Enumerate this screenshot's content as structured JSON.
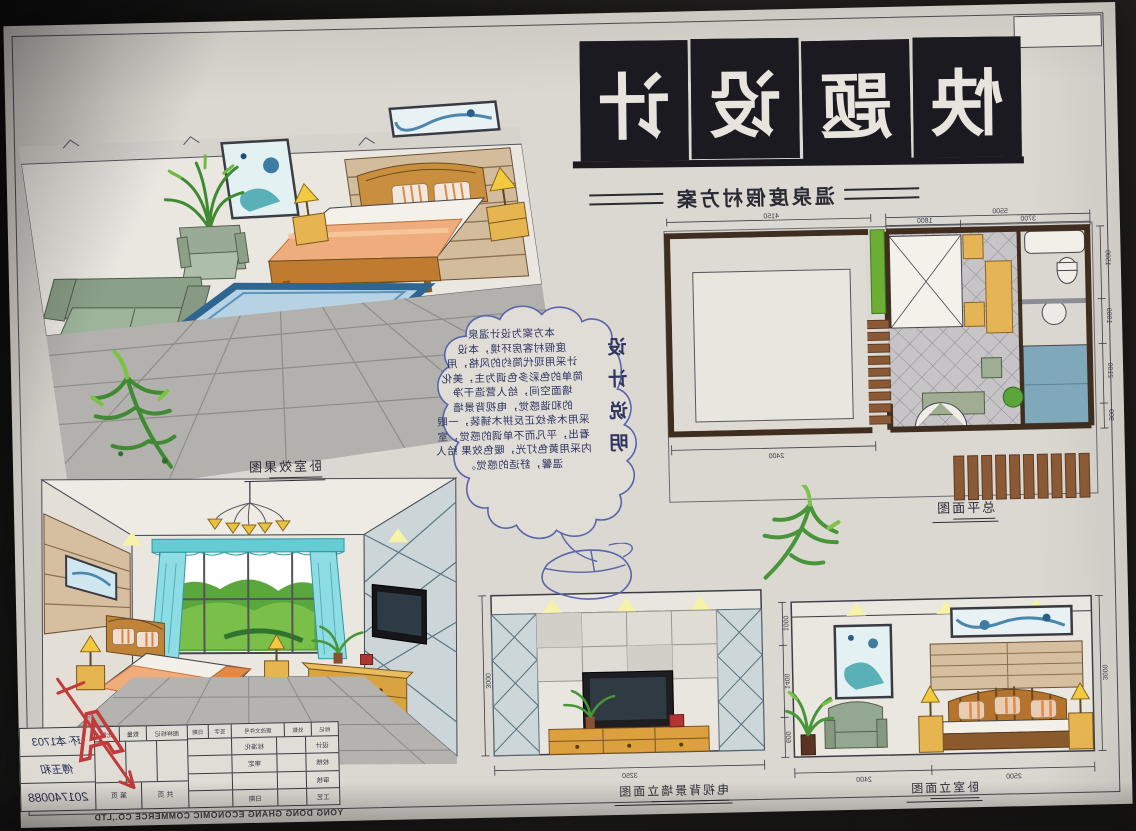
{
  "sheet": {
    "title": "快题设计",
    "title_chars": [
      "快",
      "题",
      "设",
      "计"
    ],
    "subtitle": "温泉度假村方案",
    "labels": {
      "perspective": "卧室效果图",
      "plan": "总平面图",
      "tv_elevation": "电视背景墙立面图",
      "bed_elevation": "卧室立面图"
    },
    "notes": {
      "heading": "设计说明",
      "lines": [
        "本方案为设计温泉",
        "度假村客房环境，本设",
        "计采用现代简约的风格，用",
        "简单的色彩多色调为主，美化",
        "墙面空间，给人营造干净",
        "的和谐感觉，电视背景墙",
        "采用木条纹正反拼木铺装，一眼",
        "看出，平凡而不单调的感觉，室",
        "内采用黄色灯光，暖色效果 给人",
        "温馨，舒适的感觉。"
      ]
    },
    "plan_dims": {
      "left_total": "5500",
      "left_sub1": "3700",
      "left_sub2": "1800",
      "right_total": "4150",
      "bottom": "2400",
      "side1": "1500",
      "side2": "1000",
      "side3": "2100",
      "side4": "900"
    },
    "tv_elevation_dims": {
      "width": "3250",
      "height": "3000"
    },
    "bed_elevation_dims": {
      "bed_width": "2500",
      "chair_width": "2400",
      "height": "3000",
      "side1": "1000",
      "side2": "1400",
      "side3": "600"
    },
    "title_block": {
      "class_no": "环·本1703",
      "designer": "傅玉和",
      "student_id": "201740088",
      "header": [
        "标记",
        "处数",
        "更改文件号",
        "签字",
        "日期"
      ],
      "row_labels": [
        [
          "设计",
          "标准化"
        ],
        [
          "校核",
          "审定"
        ],
        [
          "审核",
          ""
        ],
        [
          "工艺",
          "日期"
        ]
      ],
      "spec_labels": [
        "图样标记",
        "数量",
        "比例"
      ],
      "page_labels": [
        "共  页",
        "第  页"
      ]
    },
    "footer": "YONG DONG GHANG ECONOMIC COMMERCE CO.,LTD",
    "grade_mark": "A",
    "colors": {
      "accent_wood": "#dca23f",
      "accent_blue": "#5b9fc0",
      "accent_green": "#6fae3a",
      "rug_blue": "#7aa7c7",
      "title_ink": "#1a1a20",
      "pen_blue": "#2f3560",
      "grade_red": "#c23a3a"
    }
  }
}
